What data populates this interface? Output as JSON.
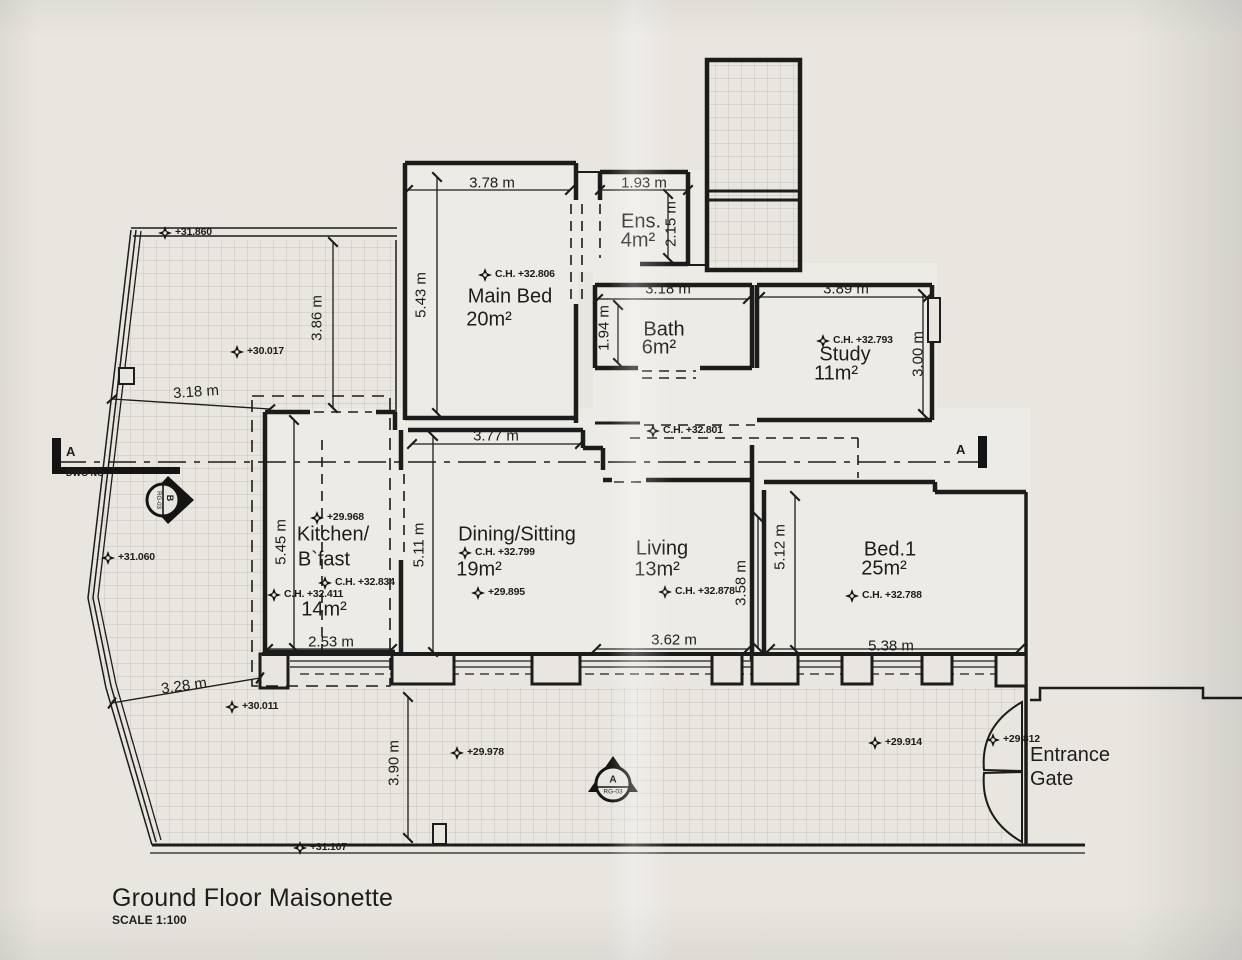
{
  "title": {
    "text": "Ground Floor Maisonette",
    "scale": "SCALE 1:100"
  },
  "markers": {
    "section_letter_left": "A",
    "dwg_no": "DWG NO",
    "section_letter_right": "A",
    "b_letter": "B",
    "b_ref": "RG-03",
    "a_letter": "A",
    "a_ref": "RG-03"
  },
  "rooms": {
    "main_bed": {
      "name": "Main Bed",
      "area": "20m²"
    },
    "ens": {
      "name": "Ens.",
      "area": "4m²"
    },
    "bath": {
      "name": "Bath",
      "area": "6m²"
    },
    "study": {
      "name": "Study",
      "area": "11m²"
    },
    "kitchen": {
      "name1": "Kitchen/",
      "name2": "B`fast",
      "area": "14m²"
    },
    "dining": {
      "name": "Dining/Sitting",
      "area": "19m²"
    },
    "living": {
      "name": "Living",
      "area": "13m²"
    },
    "bed1": {
      "name": "Bed.1",
      "area": "25m²"
    },
    "entrance": {
      "line1": "Entrance",
      "line2": "Gate"
    }
  },
  "dimensions": {
    "main_bed_w": "3.78 m",
    "ens_w": "1.93 m",
    "ens_d": "2.15 m",
    "main_bed_d": "5.43 m",
    "bath_w": "3.18 m",
    "bath_d": "1.94 m",
    "study_w": "3.89 m",
    "study_d": "3.00 m",
    "yard_nw_d": "3.86 m",
    "yard_kitchen_w": "3.18 m",
    "hall_w": "3.77 m",
    "kitchen_d": "5.45 m",
    "dining_d": "5.11 m",
    "bed1_d": "5.12 m",
    "living_d": "3.58 m",
    "living_w": "3.62 m",
    "bed1_w": "5.38 m",
    "kitchen_w": "2.53 m",
    "yard_sw": "3.28 m",
    "yard_s_d": "3.90 m"
  },
  "levels": {
    "nw": "+31.860",
    "yard_upper": "+30.017",
    "west": "+31.060",
    "kitchen_floor": "+29.968",
    "kitchen_ch": "C.H. +32.834",
    "kitchen_ch2": "C.H. +32.411",
    "dining_floor": "+29.895",
    "dining_ch": "C.H. +32.799",
    "hall_ch": "C.H. +32.801",
    "main_bed_ch": "C.H. +32.806",
    "study_ch": "C.H. +32.793",
    "living_ch": "C.H. +32.878",
    "bed1_ch": "C.H. +32.788",
    "yard_s1": "+30.011",
    "yard_s2": "+29.978",
    "yard_s3": "+29.914",
    "gate": "+29.812",
    "street": "+31.107"
  }
}
